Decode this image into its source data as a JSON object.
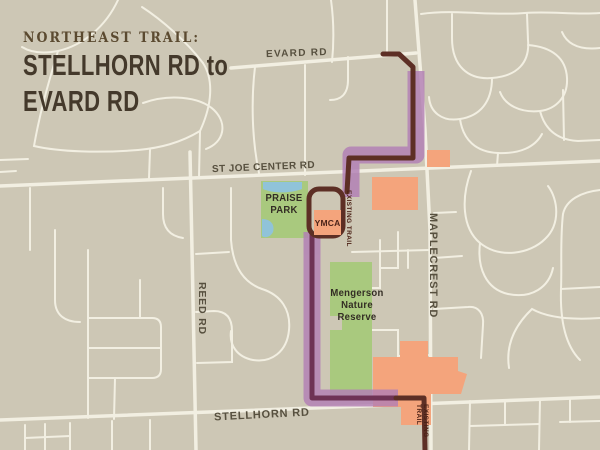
{
  "title": {
    "kicker": "NORTHEAST TRAIL:",
    "line1": "STELLHORN RD to",
    "line2": "EVARD RD"
  },
  "road_labels": {
    "evard": "EVARD RD",
    "st_joe_center": "ST JOE CENTER RD",
    "stellhorn": "STELLHORN RD",
    "reed": "REED RD",
    "maplecrest": "MAPLECREST RD"
  },
  "areas": {
    "praise_park_lines": [
      "PRAISE",
      "PARK"
    ],
    "ymca": "YMCA",
    "mengerson_lines": [
      "Mengerson",
      "Nature",
      "Reserve"
    ]
  },
  "trail_labels": {
    "existing_trail_upper": "EXISTING TRAIL",
    "existing_trail_lower": "EXISTING TRAIL"
  },
  "colors": {
    "bg": "#cdc7b5",
    "road": "#f2efe2",
    "trail_purple": "#b27fb5",
    "trail_core": "#6e3355",
    "existing_brown": "#5d2f25",
    "park_green": "#a9c97e",
    "water_blue": "#90c3d9",
    "orange": "#f4a47c",
    "road_label": "#57503f",
    "title_kicker": "#5b4a30",
    "title_main": "#44392b",
    "area_label": "#332d24",
    "ymca_text": "#4c241a",
    "existing_label": "#4a2015"
  }
}
